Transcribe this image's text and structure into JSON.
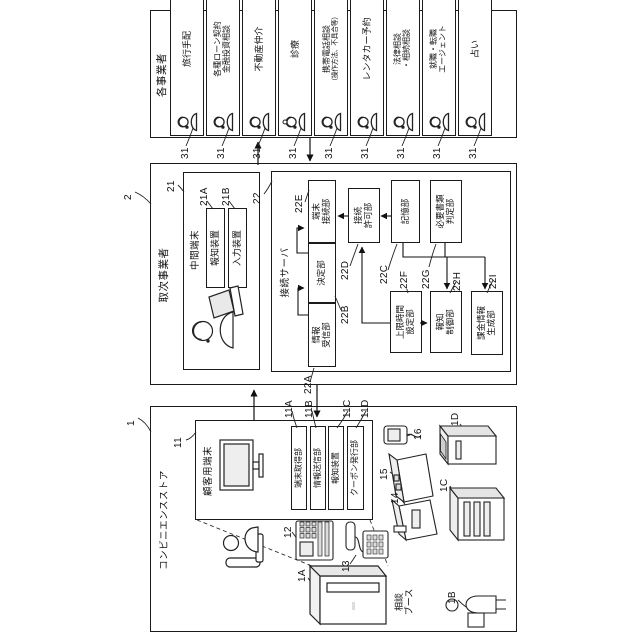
{
  "store": {
    "ref": "1",
    "title": "コンビニエンスストア",
    "terminal": {
      "ref": "11",
      "title": "顧客用端末",
      "units": [
        {
          "ref": "11A",
          "name": "端末取得部"
        },
        {
          "ref": "11B",
          "name": "情報送信部"
        },
        {
          "ref": "11C",
          "name": "報知装置"
        },
        {
          "ref": "11D",
          "name": "クーポン発行部"
        }
      ]
    },
    "device_refs": {
      "r12": "12",
      "r13": "13",
      "r14": "14",
      "r15": "15",
      "r16": "16"
    },
    "booth": {
      "ref": "1A",
      "line1": "相談",
      "line2": "ブース"
    },
    "machines": {
      "b": "1B",
      "c": "1C",
      "d": "1D"
    }
  },
  "agency": {
    "ref": "2",
    "title": "取次事業者",
    "terminal": {
      "ref": "21",
      "title": "中間端末",
      "units": [
        {
          "ref": "21A",
          "name": "報知装置"
        },
        {
          "ref": "21B",
          "name": "入力装置"
        }
      ]
    },
    "server": {
      "ref": "22",
      "title": "接続サーバ",
      "units": {
        "a": {
          "ref": "22A",
          "line1": "情報",
          "line2": "受信部"
        },
        "b": {
          "ref": "22B",
          "line1": "決定部",
          "line2": ""
        },
        "e": {
          "ref": "22E",
          "line1": "端末",
          "line2": "接続部"
        },
        "d": {
          "ref": "22D",
          "line1": "接続",
          "line2": "許可部"
        },
        "c": {
          "ref": "22C",
          "line1": "記憶部",
          "line2": ""
        },
        "g": {
          "ref": "22G",
          "line1": "必要書類",
          "line2": "判定部"
        },
        "f": {
          "ref": "22F",
          "line1": "上限時間",
          "line2": "設定部"
        },
        "h": {
          "ref": "22H",
          "line1": "報知",
          "line2": "制御部"
        },
        "i": {
          "ref": "22I",
          "line1": "課金情報",
          "line2": "生成部"
        }
      }
    }
  },
  "operators": {
    "title": "各事業者",
    "ref": "31",
    "items": [
      {
        "line1": "旅行手配",
        "line2": ""
      },
      {
        "line1": "各種ローン契約",
        "line2": "金融投資相談"
      },
      {
        "line1": "不動産仲介",
        "line2": ""
      },
      {
        "line1": "診療",
        "line2": ""
      },
      {
        "line1": "携帯電話相談",
        "line2": "（操作方法、不具合等）"
      },
      {
        "line1": "レンタカー予約",
        "line2": ""
      },
      {
        "line1": "法律相談",
        "line2": "・相続相談"
      },
      {
        "line1": "就職・転職",
        "line2": "エージェント"
      },
      {
        "line1": "占い",
        "line2": ""
      }
    ]
  }
}
